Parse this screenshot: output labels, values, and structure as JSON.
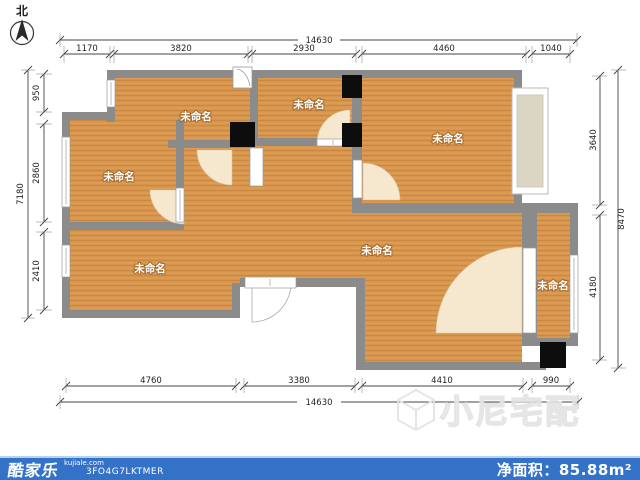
{
  "north": {
    "label": "北"
  },
  "rooms": [
    {
      "label": "未命名"
    },
    {
      "label": "未命名"
    },
    {
      "label": "未命名"
    },
    {
      "label": "未命名"
    },
    {
      "label": "未命名"
    },
    {
      "label": "未命名"
    },
    {
      "label": "未命名"
    }
  ],
  "dimensions": {
    "top_total": "14630",
    "top": [
      "1170",
      "3820",
      "2930",
      "4460",
      "1040"
    ],
    "left_total": "7180",
    "left": [
      "950",
      "2860",
      "2410"
    ],
    "right_total": "8470",
    "right": [
      "3640",
      "4180"
    ],
    "bottom": [
      "4760",
      "3380",
      "4410",
      "990"
    ],
    "bottom_total": "14630"
  },
  "watermark": {
    "text": "小尼宅配"
  },
  "footer": {
    "brand": "酷家乐",
    "site": "kujiale.com",
    "code": "3FO4G7LKTMER",
    "area_label": "净面积：",
    "area_value": "85.88m²",
    "bar_color": "#3472C8"
  },
  "colors": {
    "floor": "#D6944C",
    "wall": "#8B8B8B",
    "door_arc": "#F6E7CF",
    "bay_fill": "#DBD5C3",
    "column": "#0D0D0D"
  }
}
